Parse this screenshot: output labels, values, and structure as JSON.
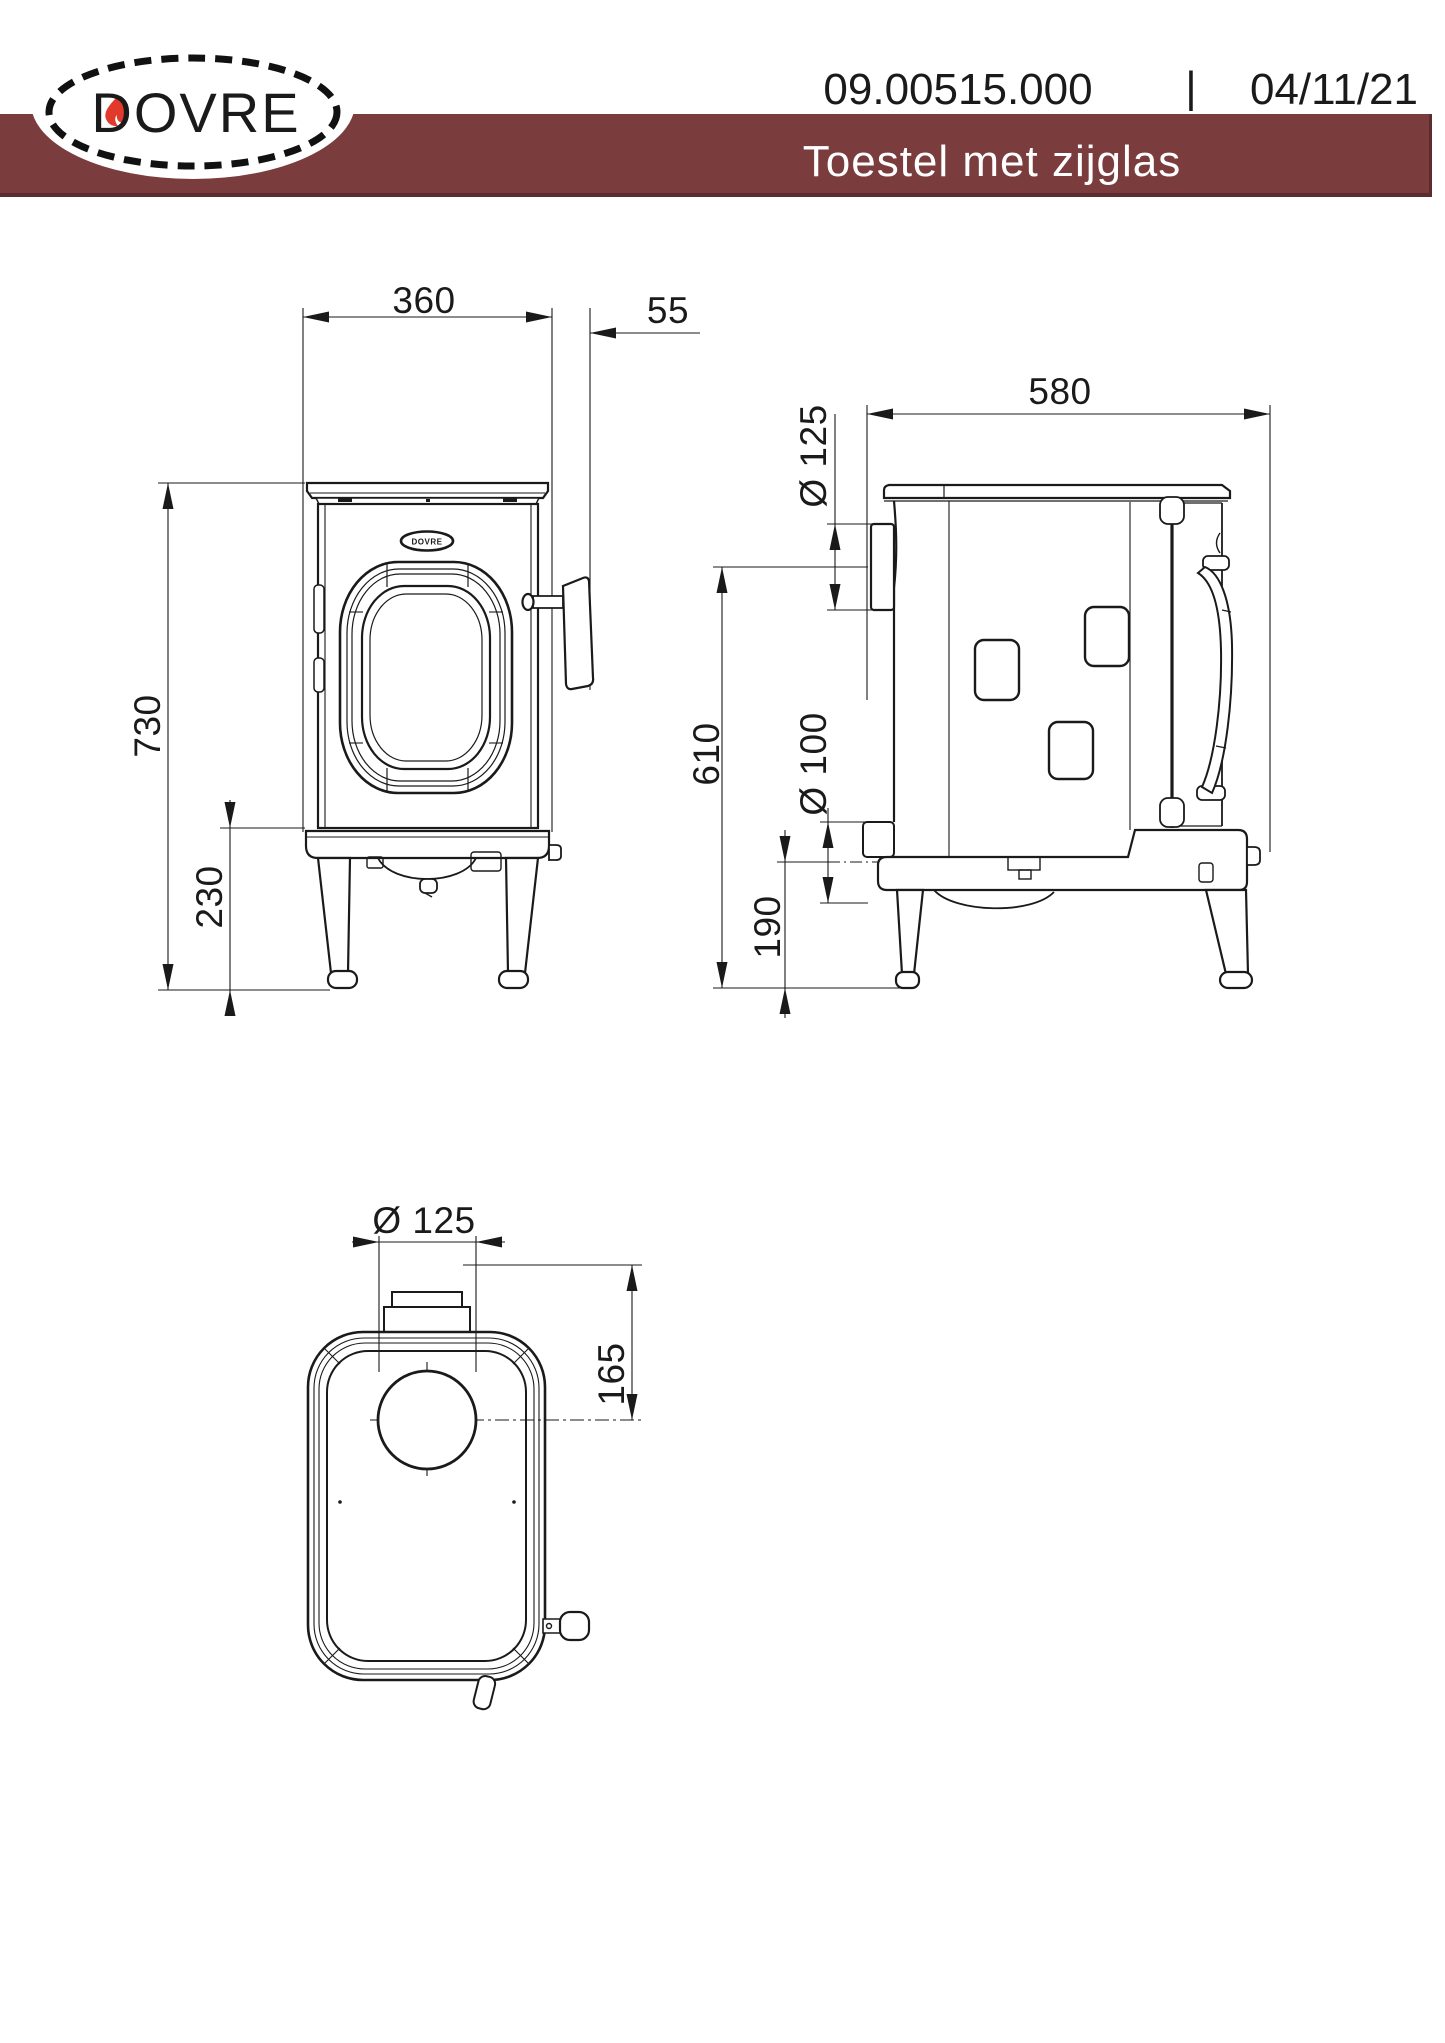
{
  "header": {
    "logo_text": "DOVRE",
    "doc_number": "09.00515.000",
    "separator": "|",
    "date": "04/11/21",
    "banner_title": "Toestel met zijglas"
  },
  "colors": {
    "banner": "#7a3c3d",
    "banner_edge": "#5c2d2e",
    "line": "#1a1a1a",
    "flame": "#e13a2c"
  },
  "front_view": {
    "logo_text": "DOVRE",
    "dim_width": "360",
    "dim_handle": "55",
    "dim_height": "730",
    "dim_base_height": "230"
  },
  "side_view": {
    "dim_depth": "580",
    "dim_flue_diameter": "Ø 125",
    "dim_flue_height": "610",
    "dim_air_diameter": "Ø 100",
    "dim_air_height": "190"
  },
  "top_view": {
    "dim_flue_diameter": "Ø 125",
    "dim_flue_offset": "165"
  }
}
